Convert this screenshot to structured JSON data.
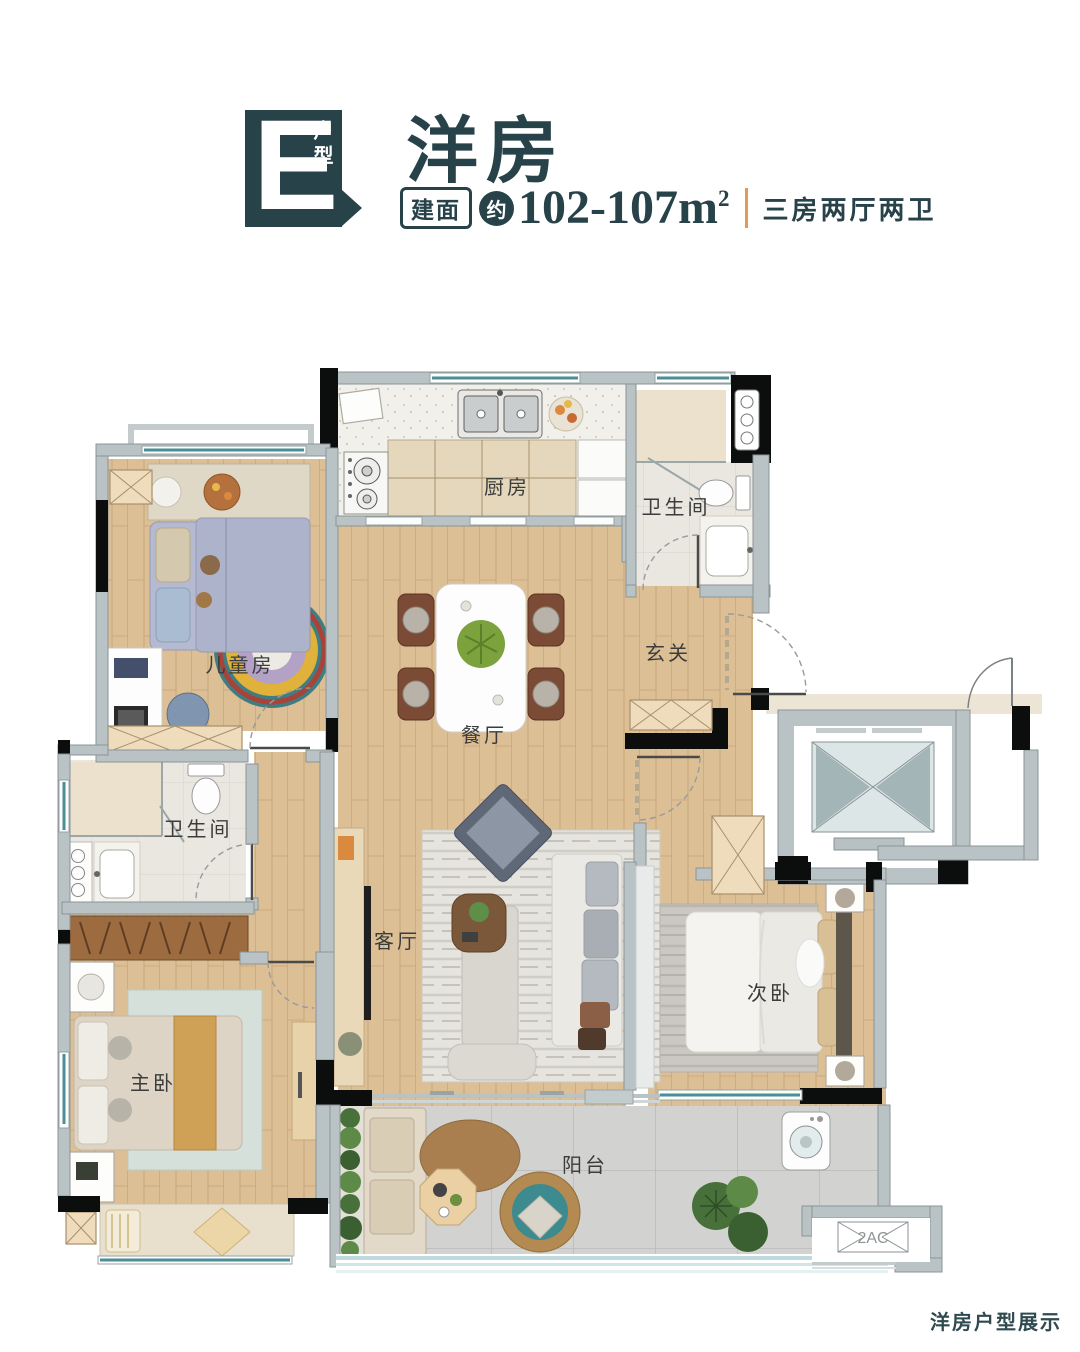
{
  "header": {
    "unit_letter": "E",
    "unit_label": "户型",
    "title": "洋房",
    "area_tag": "建面",
    "area_prefix": "约",
    "area_value": "102-107m",
    "area_exponent": "2",
    "layout_spec": "三房两厅两卫"
  },
  "rooms": {
    "kitchen": "厨房",
    "bath_top": "卫生间",
    "entry": "玄关",
    "dining": "餐厅",
    "kids": "儿童房",
    "bath_left": "卫生间",
    "living": "客厅",
    "master": "主卧",
    "second": "次卧",
    "balcony": "阳台"
  },
  "annotations": {
    "ac_platform": "2AC"
  },
  "footer": {
    "caption": "洋房户型展示"
  },
  "colors": {
    "accent_teal": "#28424a",
    "divider_orange": "#e09b54"
  }
}
